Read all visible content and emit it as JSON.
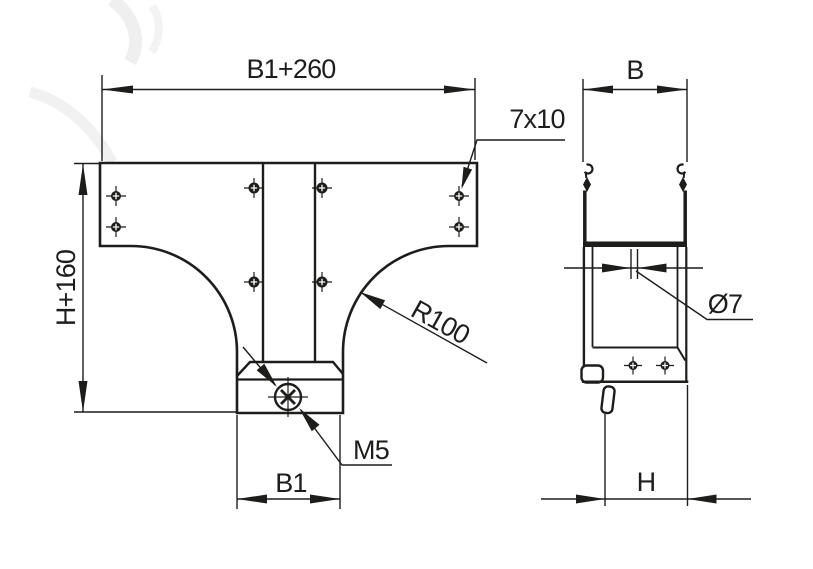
{
  "drawing": {
    "front_view": {
      "top_width_label": "B1+260",
      "height_label": "H+160",
      "spout_width_label": "B1",
      "hole_slot_label": "7x10",
      "fillet_radius_label": "R100",
      "thread_label": "M5"
    },
    "side_view": {
      "width_label": "B",
      "depth_label": "H",
      "hole_diameter_label": "Ø7"
    },
    "colors": {
      "ink": "#1d1d1b",
      "paper": "#ffffff",
      "watermark": "#ededed"
    }
  }
}
